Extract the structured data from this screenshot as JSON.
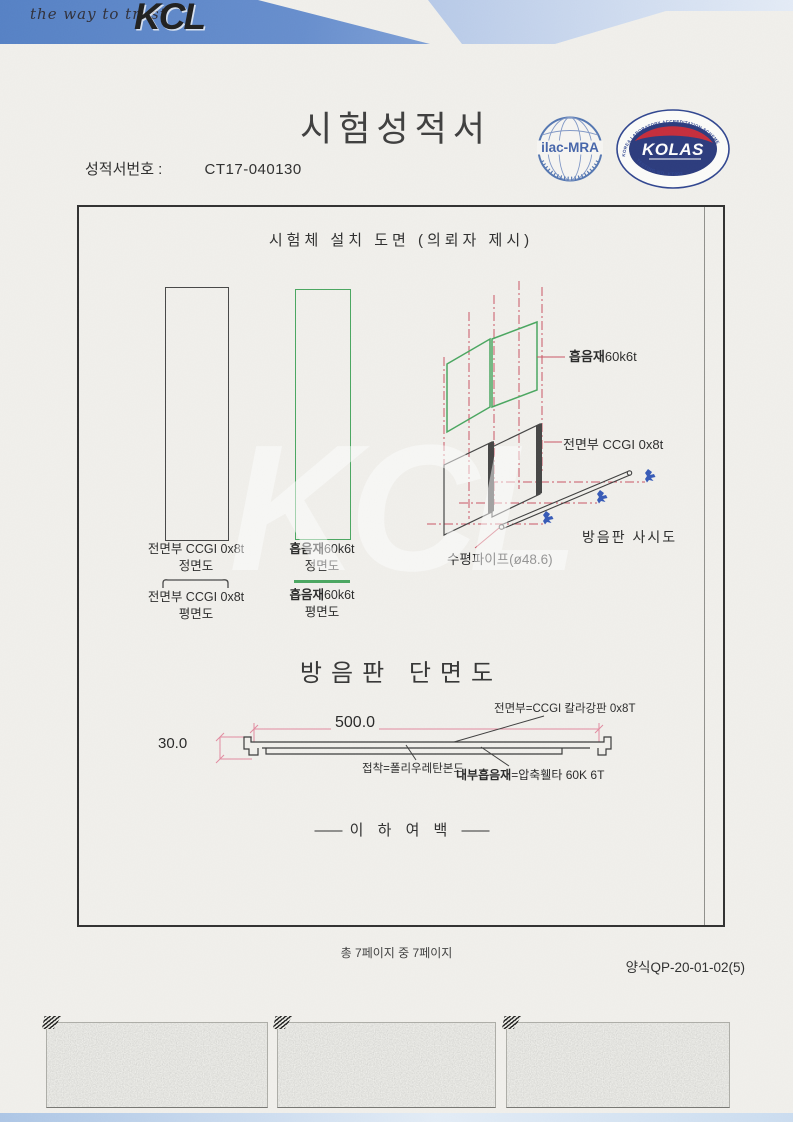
{
  "header": {
    "tagline": "the way to trust",
    "logo": "KCL"
  },
  "doc": {
    "title": "시험성적서",
    "report_no_label": "성적서번호 :",
    "report_no": "CT17-040130"
  },
  "certs": {
    "ilac_text": "ilac-MRA",
    "kolas_name": "KOLAS",
    "kolas_top": "KOREA LABORATORY ACCREDITATION SCHEME",
    "kolas_bottom": "TESTING NO. KT002"
  },
  "box": {
    "title": "시험체 설치 도면 (의뢰자 제시)",
    "labels": {
      "front_panel": "전면부 CCGI 0x8t",
      "absorber_bold": "흡음재",
      "absorber_spec": "60k6t",
      "front_view": "정면도",
      "plan_view": "평면도",
      "pipe": "수평파이프(ø48.6)",
      "iso_view": "방음판 사시도"
    },
    "section": {
      "title": "방음판 단면도",
      "dim_w": "500.0",
      "dim_h": "30.0",
      "front_note": "전면부=CCGI 칼라강판 0x8T",
      "adhesive_note": "접착=폴리우레탄본드",
      "core_bold": "내부흡음재",
      "core_rest": "=압축휄타 60K 6T"
    },
    "end_note_dash": "――",
    "end_note": "이 하 여 백"
  },
  "footer": {
    "page_info": "총 7페이지 중 7페이지",
    "form_no": "양식QP-20-01-02(5)"
  },
  "watermark": "KCL",
  "colors": {
    "header_blue": "#4b7ac3",
    "green_line": "#3fa257",
    "centerline_red": "#c84b5c",
    "dimension_pink": "#e2849b",
    "kolas_navy": "#1e2f76",
    "kolas_red": "#c32030",
    "ilac_blue": "#3a5ca6",
    "clamp_blue": "#2a50b4"
  }
}
